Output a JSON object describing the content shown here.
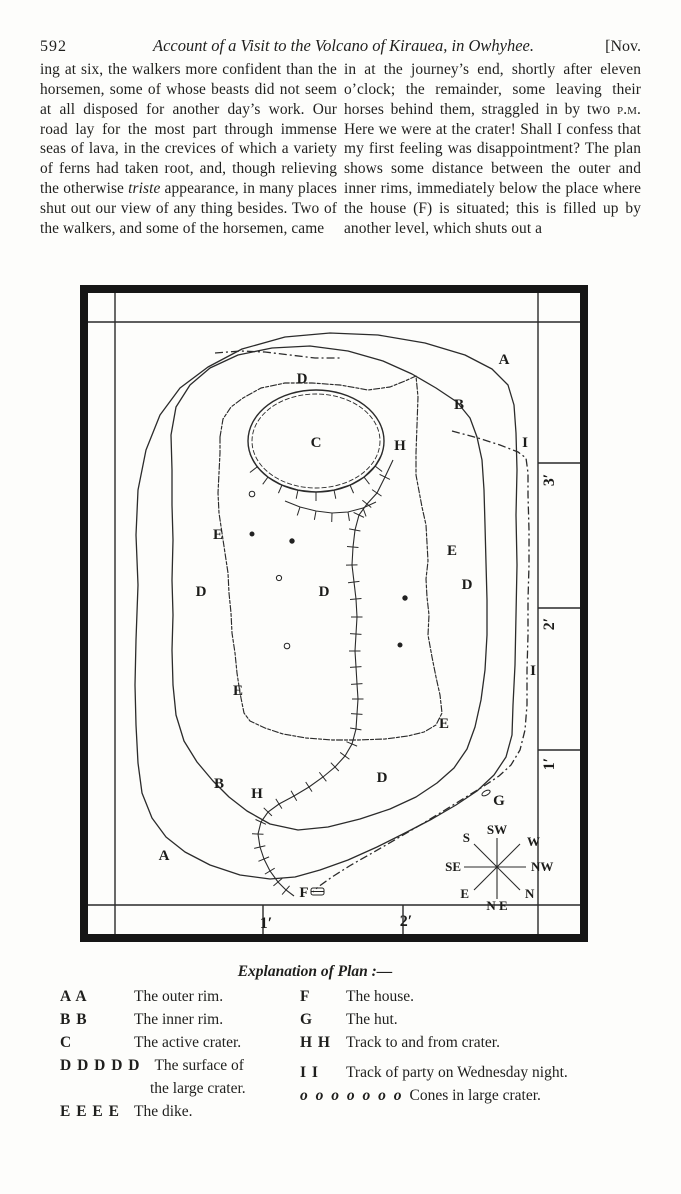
{
  "page": {
    "number": "592",
    "running_title": "Account of a Visit to the Volcano of Kirauea, in Owhyhee.",
    "issue": "[Nov."
  },
  "body": {
    "left_column": {
      "part1": "ing at six, the walkers more confident than the horsemen, some of whose beasts did not seem at all disposed for another day’s work.  Our road lay for the most part through immense seas of lava, in the crevices of which a variety of ferns had taken root, and, though relieving the otherwise ",
      "italic": "triste",
      "part2": " appearance, in many places shut out our view of any thing besides.  Two of the walkers, and some of the horsemen, came"
    },
    "right_column": {
      "part1": "in at the journey’s end, shortly after eleven o’clock; the remainder, some leaving their horses behind them, straggled in by two ",
      "smallcaps": "p.m.",
      "part2": "  Here we were at the crater!  Shall I confess that my first feeling was disappointment?  The plan shows some distance between the outer and inner rims, immediately below the place where the house (F) is situated; this is filled up by another level, which shuts out a"
    }
  },
  "map": {
    "labels": [
      "A",
      "A",
      "B",
      "B",
      "C",
      "D",
      "D",
      "D",
      "D",
      "D",
      "E",
      "E",
      "E",
      "E",
      "H",
      "H",
      "I",
      "I",
      "F",
      "G"
    ],
    "compass_points": [
      "SW",
      "W",
      "NW",
      "N",
      "N E",
      "E",
      "SE",
      "S"
    ],
    "scale_right": [
      "3′",
      "2′",
      "1′"
    ],
    "scale_bottom": [
      "1′",
      "2′"
    ]
  },
  "legend": {
    "title": "Explanation of Plan :—",
    "left": [
      {
        "key": "A A",
        "desc": "The outer rim."
      },
      {
        "key": "B B",
        "desc": "The inner rim."
      },
      {
        "key": "C",
        "desc": "The active crater."
      },
      {
        "key": "D D D D D",
        "desc": "The surface of",
        "desc2": "the large crater."
      },
      {
        "key": "E E E E",
        "desc": "The dike."
      }
    ],
    "right": [
      {
        "key": "F",
        "desc": "The house."
      },
      {
        "key": "G",
        "desc": "The hut."
      },
      {
        "key": "H H",
        "desc": "Track to and from crater."
      },
      {
        "key": "I I",
        "desc": "Track of party on Wednesday night."
      },
      {
        "key": "o o o o o o o",
        "desc": "Cones in large crater."
      }
    ]
  }
}
